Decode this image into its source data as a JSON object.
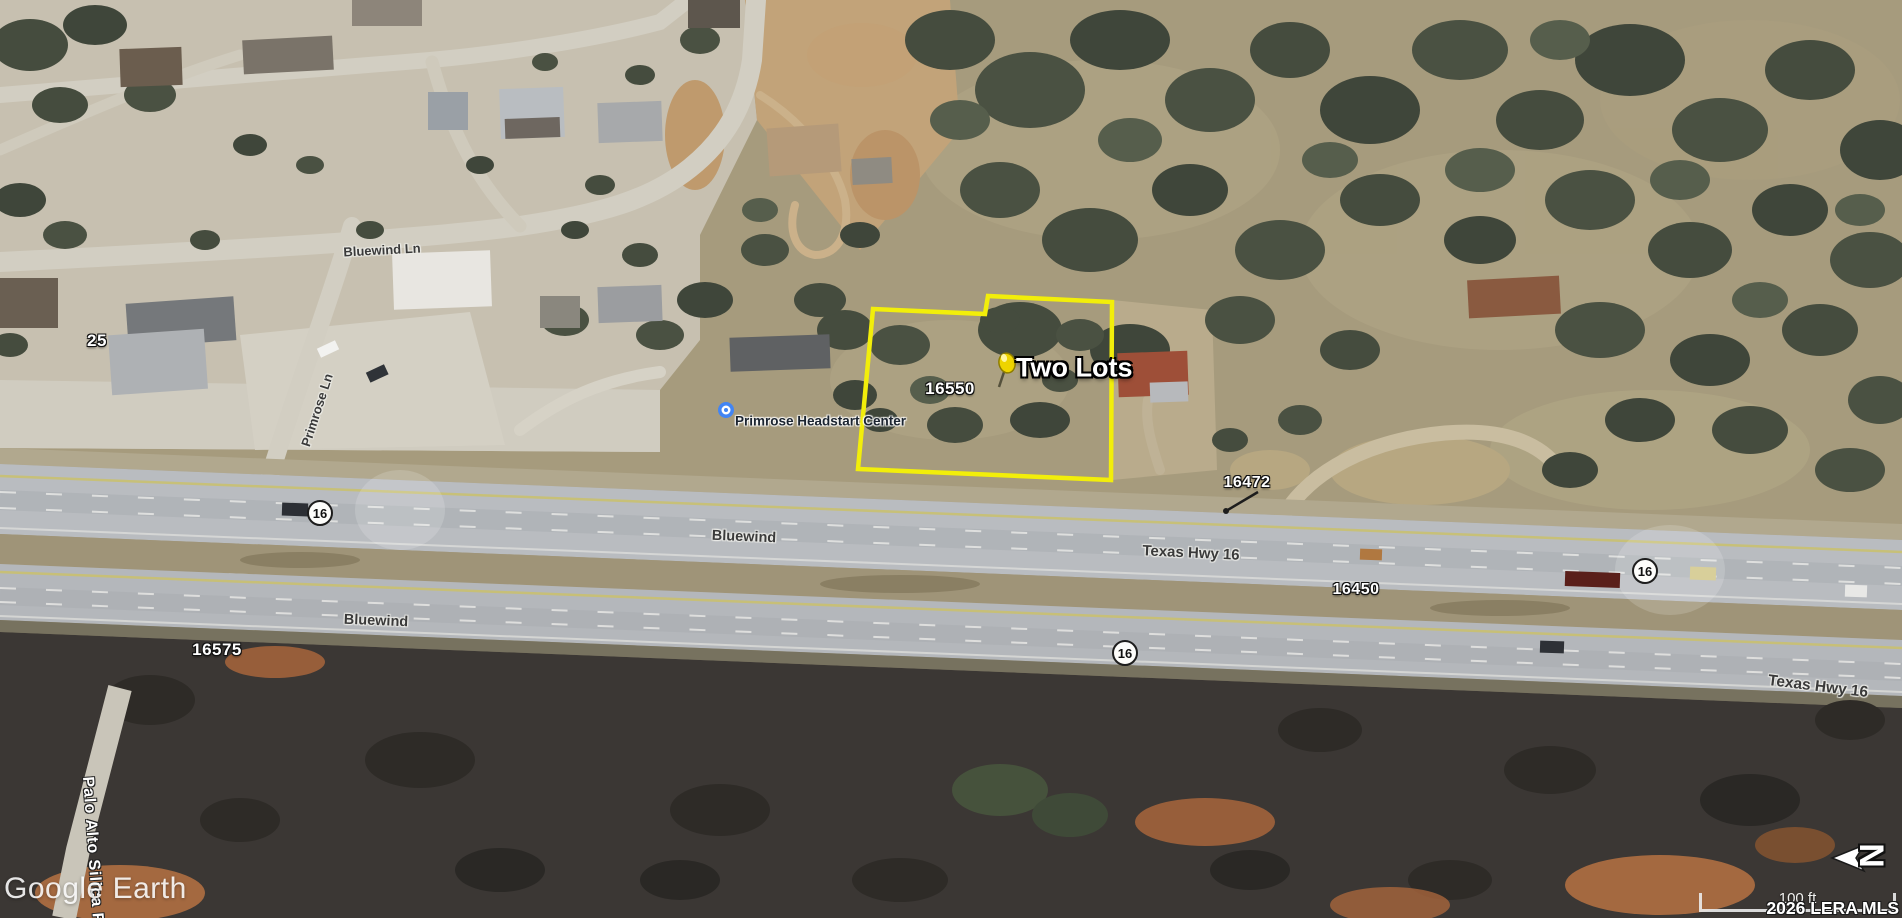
{
  "map": {
    "watermark": "Google Earth",
    "attribution": "2026 LERA MLS",
    "scale_label": "100 ft",
    "north_label": "N",
    "pin": {
      "label": "Two Lots"
    },
    "parcel_number": "16550",
    "poi_name": "Primrose Headstart Center",
    "addresses": {
      "n25": "25",
      "n16575": "16575",
      "n16472": "16472",
      "n16450": "16450"
    },
    "roads": {
      "bluewind_ln": "Bluewind Ln",
      "primrose_ln": "Primrose Ln",
      "bluewind_upper": "Bluewind",
      "bluewind_lower": "Bluewind",
      "texas_hwy_upper": "Texas Hwy 16",
      "texas_hwy_lower": "Texas Hwy 16",
      "palo_alto": "Palo Alto Silica Rd"
    },
    "shield_label": "16",
    "colors": {
      "parcel_outline": "#f2ee0a",
      "pushpin_yellow": "#eed400",
      "poi_blue": "#4285f4",
      "highway_gray": "#b8bbbf",
      "scrub_olive": "#a69b7d",
      "dark_ground": "#3b3734"
    }
  }
}
